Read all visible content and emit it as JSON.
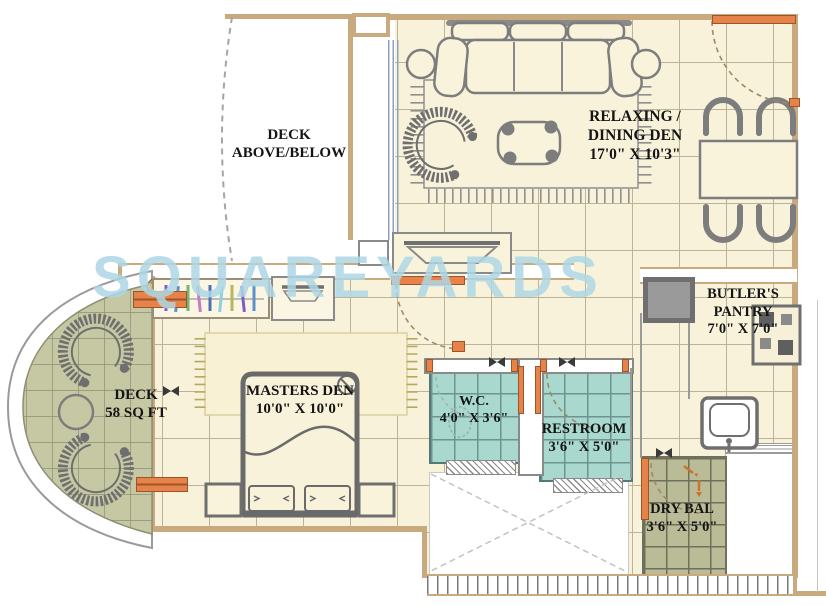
{
  "plan": {
    "watermark": "SQUAREYARDS",
    "rooms": {
      "deck_above_below": {
        "l1": "DECK",
        "l2": "ABOVE/BELOW"
      },
      "relaxing_dining_den": {
        "l1": "RELAXING /",
        "l2": "DINING DEN",
        "l3": "17'0\" X 10'3\""
      },
      "butlers_pantry": {
        "l1": "BUTLER'S",
        "l2": "PANTRY",
        "l3": "7'0\" X 7'0\""
      },
      "deck": {
        "l1": "DECK",
        "l2": "58 SQ FT"
      },
      "masters_den": {
        "l1": "MASTERS DEN",
        "l2": "10'0\" X 10'0\""
      },
      "wc": {
        "l1": "W.C.",
        "l2": "4'0\" X 3'6\""
      },
      "restroom": {
        "l1": "RESTROOM",
        "l2": "3'6\" X 5'0\""
      },
      "dry_balcony": {
        "l1": "DRY BAL",
        "l2": "3'6\" X 5'0\""
      }
    },
    "colors": {
      "floor": "#F9F2DA",
      "grid": "#BCB497",
      "wall": "#C9A97E",
      "tile_teal": "#A9D8CE",
      "deck_olive": "#C6C8A4",
      "dry_olive": "#BABB97",
      "accent_orange": "#E8824B",
      "furniture_gray": "#7D7D7D",
      "watermark_blue": "#AED7E6"
    }
  }
}
